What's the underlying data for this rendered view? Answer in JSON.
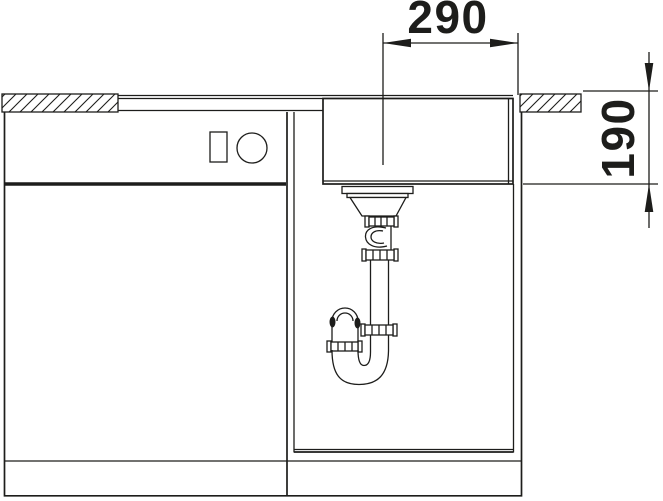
{
  "diagram": {
    "type": "technical-drawing",
    "subject": "sink base cabinet cross-section with basin and drain siphon",
    "dimension_width": "290",
    "dimension_height": "190",
    "line_color": "#1d1d1b",
    "background_color": "#ffffff"
  }
}
